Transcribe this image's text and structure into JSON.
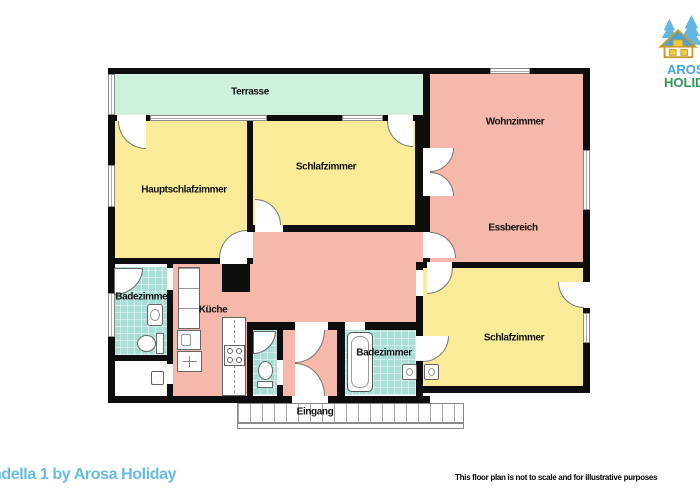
{
  "rooms": {
    "terrasse": "Terrasse",
    "hauptschlafzimmer": "Hauptschlafzimmer",
    "schlafzimmer_oben": "Schlafzimmer",
    "wohnzimmer": "Wohnzimmer",
    "essbereich": "Essbereich",
    "badezimmer_links": "Badezimmer",
    "kueche": "Küche",
    "badezimmer_unten": "Badezimmer",
    "schlafzimmer_unten": "Schlafzimmer",
    "eingang": "Eingang"
  },
  "logo": {
    "line1": "AROSA",
    "line2": "HOLIDAY"
  },
  "footer": {
    "property_title": "ndella 1 by Arosa Holiday",
    "disclaimer": "This floor plan is not to scale and for illustrative purposes"
  },
  "colors": {
    "terrace": "#cdf1dd",
    "bedroom": "#f9eb97",
    "living": "#f6b8aa",
    "bath": "#a9ded7",
    "wall": "#0d0d0d",
    "brand-blue": "#45a6d9",
    "brand-green": "#2f9655",
    "title-blue": "#66bce4"
  }
}
